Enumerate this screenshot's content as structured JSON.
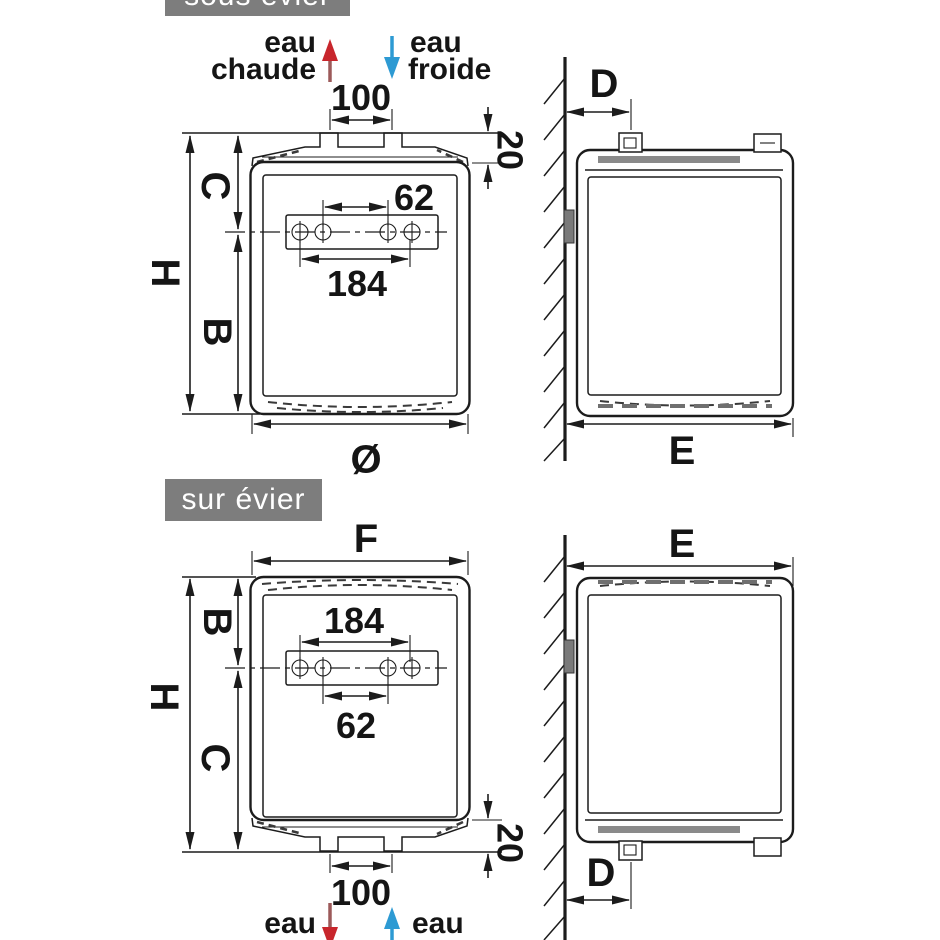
{
  "colors": {
    "hot_water": "#c8262c",
    "hot_water_stem": "#9c5a5a",
    "cold_water": "#2d9ad3",
    "label_background": "#7d7d7d",
    "label_text": "#ffffff",
    "line": "#1c1c1c"
  },
  "sections": {
    "sous_evier": {
      "title": "sous évier",
      "water": {
        "eau": "eau",
        "chaude": "chaude",
        "froide": "froide"
      },
      "dims": {
        "pipe_spacing": "100",
        "cap_height": "20",
        "top_to_axis": "C",
        "height": "H",
        "axis_to_bottom": "B",
        "holes_inner": "62",
        "holes_outer": "184",
        "diameter": "Ø",
        "wall_offset": "D",
        "depth": "E"
      }
    },
    "sur_evier": {
      "title": "sur évier",
      "water": {
        "eau": "eau",
        "chaude": "chaude",
        "froide": "froide"
      },
      "dims": {
        "width": "F",
        "top_to_axis": "B",
        "height": "H",
        "axis_to_bottom": "C",
        "holes_outer": "184",
        "holes_inner": "62",
        "cap_height": "20",
        "pipe_spacing": "100",
        "wall_offset": "D",
        "depth": "E"
      }
    }
  }
}
